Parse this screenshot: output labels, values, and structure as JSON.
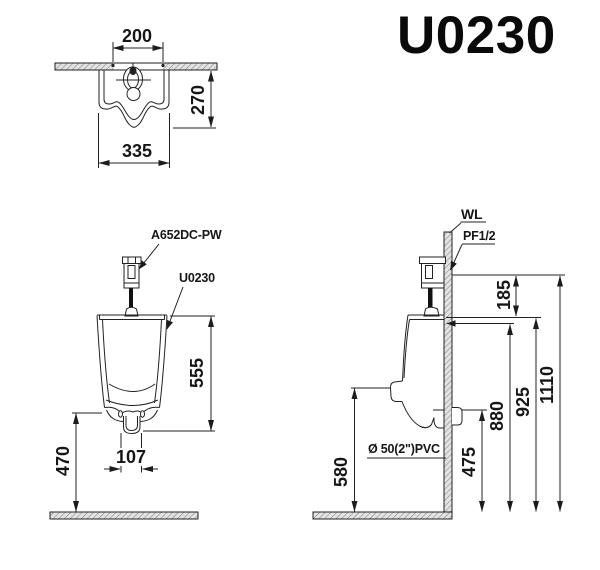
{
  "title": "U0230",
  "views": {
    "top": {
      "dim_spread": "200",
      "dim_depth": "270",
      "dim_width": "335"
    },
    "front": {
      "label_valve": "A652DC-PW",
      "label_model": "U0230",
      "dim_body_height": "555",
      "dim_outlet_width": "107",
      "dim_bottom_to_floor": "470"
    },
    "side": {
      "label_wall_line": "WL",
      "label_supply": "PF1/2",
      "label_drain": "Ø 50(2\")PVC",
      "dim_supply_to_rim": "185",
      "dim_spud_height": "880",
      "dim_rim_height": "925",
      "dim_supply_height": "1110",
      "dim_outlet_height": "475",
      "dim_body_bottom_height": "580"
    }
  }
}
